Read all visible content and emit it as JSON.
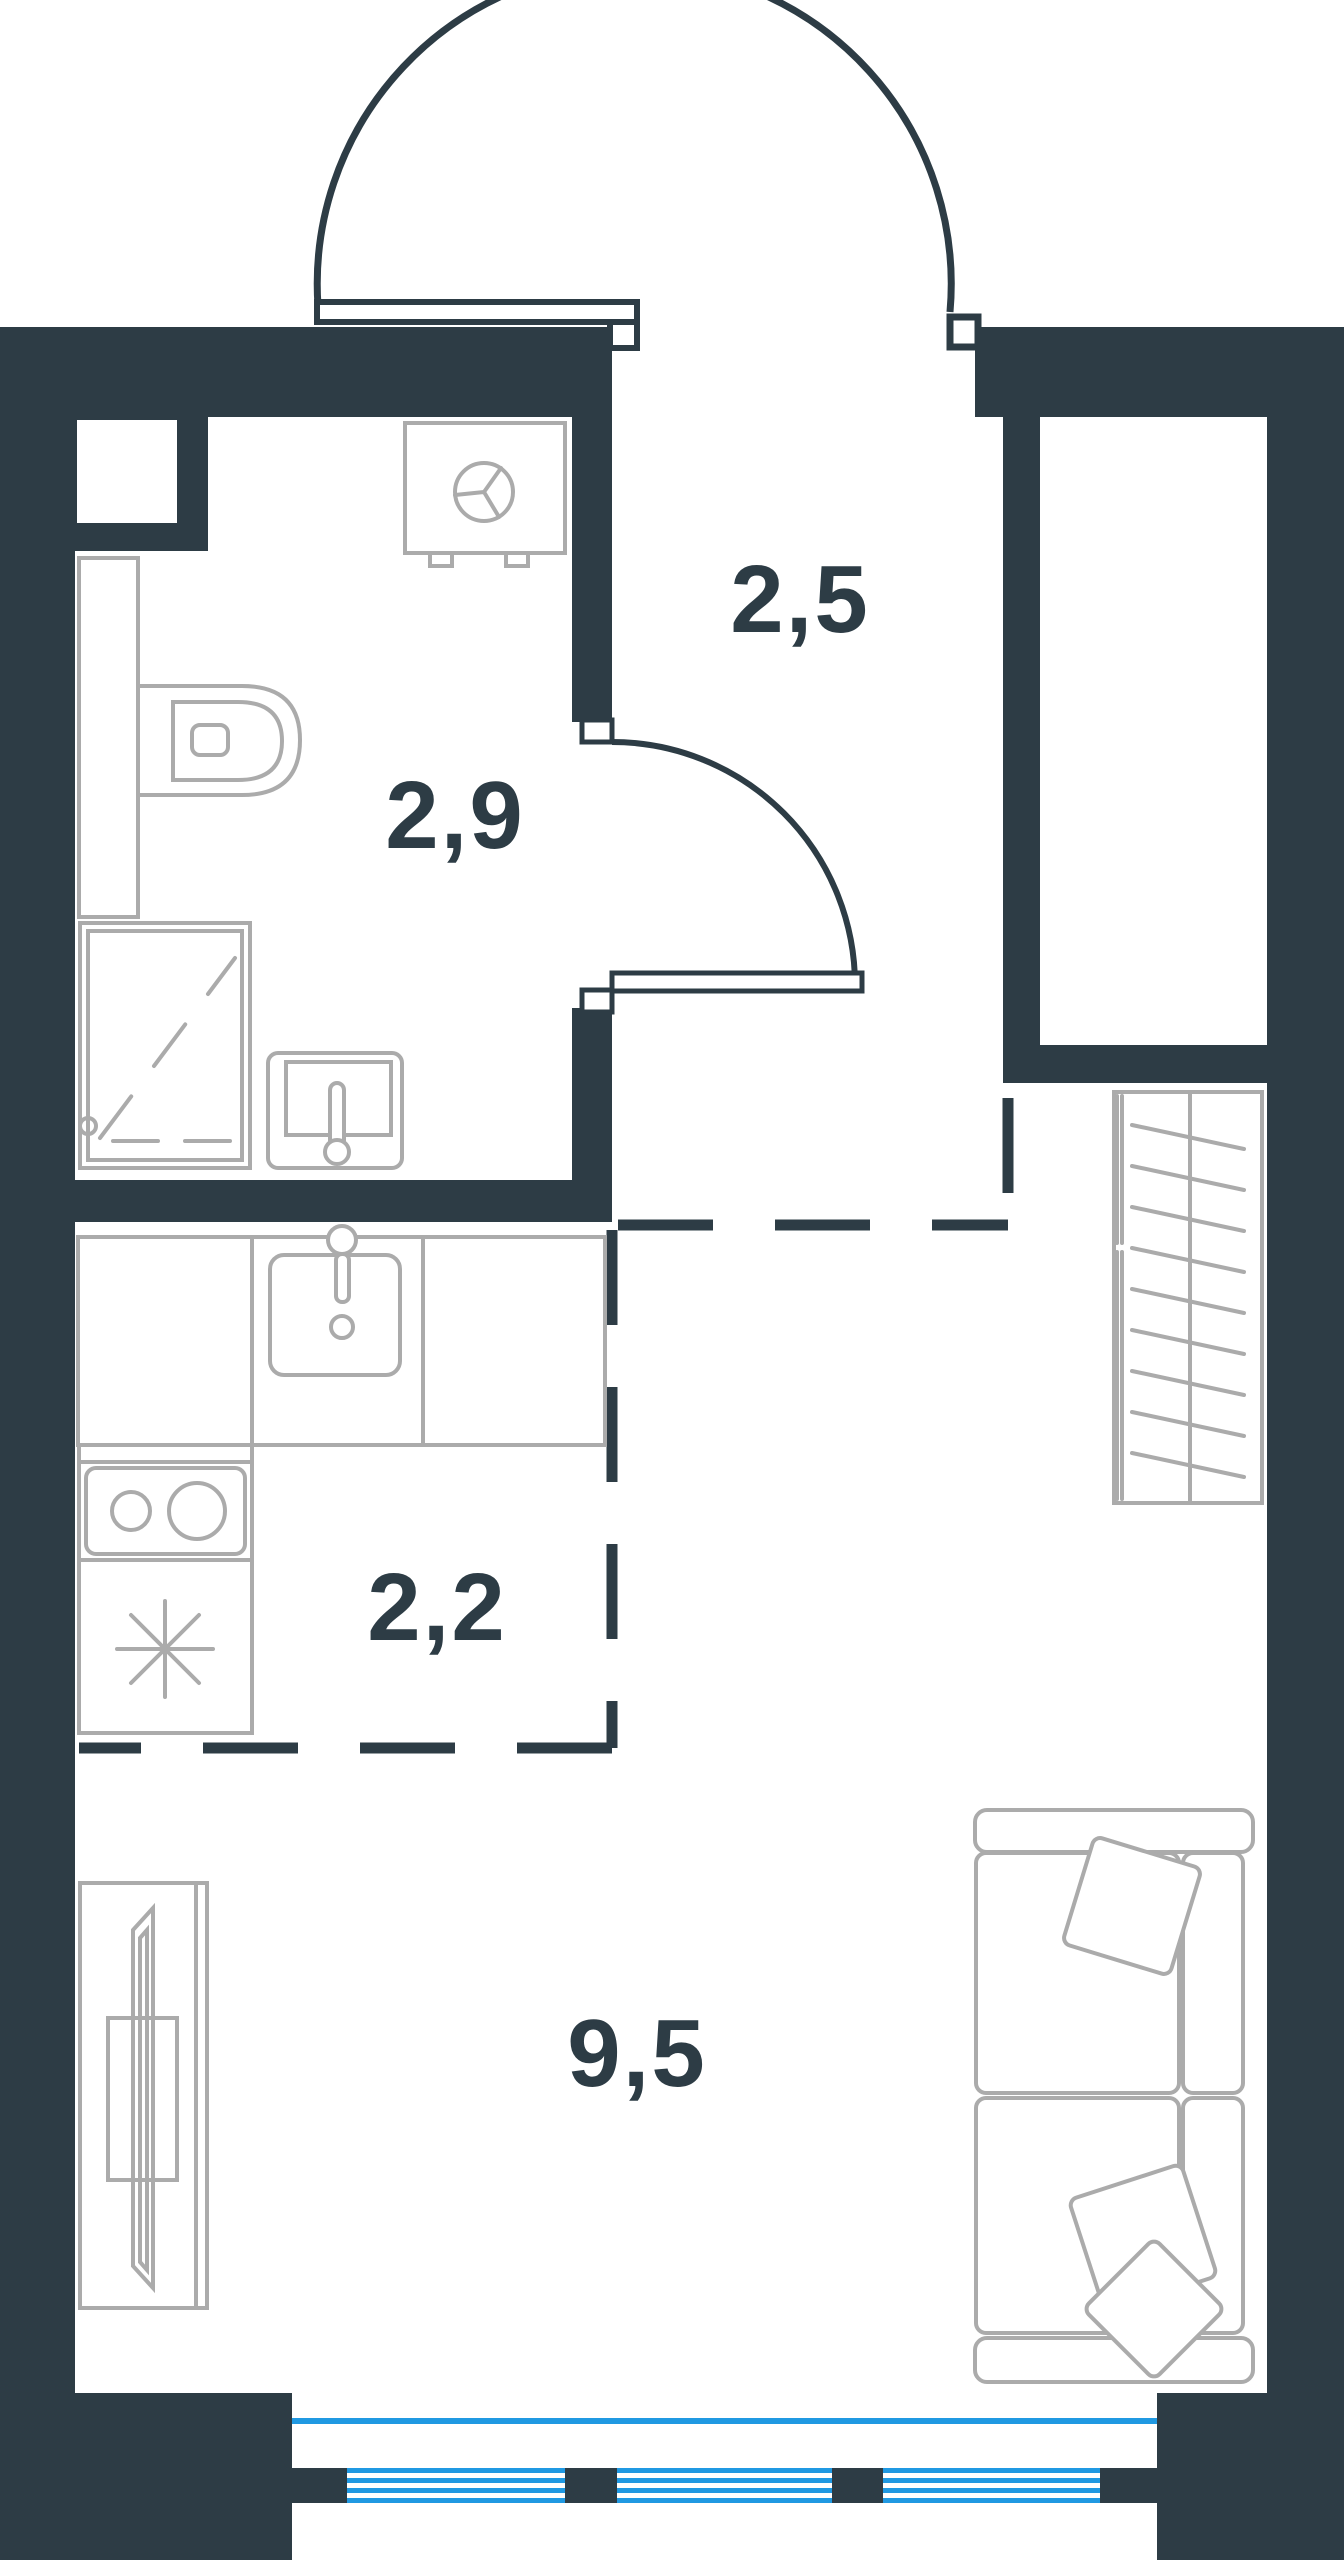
{
  "plan": {
    "type": "studio-apartment-floor-plan",
    "area_unit_shown": "",
    "rooms": [
      {
        "name": "hallway",
        "area": "2,5"
      },
      {
        "name": "bathroom",
        "area": "2,9"
      },
      {
        "name": "kitchen",
        "area": "2,2"
      },
      {
        "name": "living-room",
        "area": "9,5"
      }
    ],
    "colors": {
      "wall": "#2d3c45",
      "furniture": "#ababab",
      "window": "#2099e2",
      "label": "#2d3c45",
      "background": "#ffffff"
    },
    "fixtures": [
      "entrance-door",
      "bathroom-door",
      "washing-machine",
      "toilet",
      "shower",
      "bathroom-sink",
      "vanity-counter",
      "kitchen-counter",
      "kitchen-sink",
      "stove",
      "fridge",
      "wardrobe",
      "sofa",
      "pillows",
      "tv-stand",
      "window",
      "balcony-glazing"
    ]
  }
}
